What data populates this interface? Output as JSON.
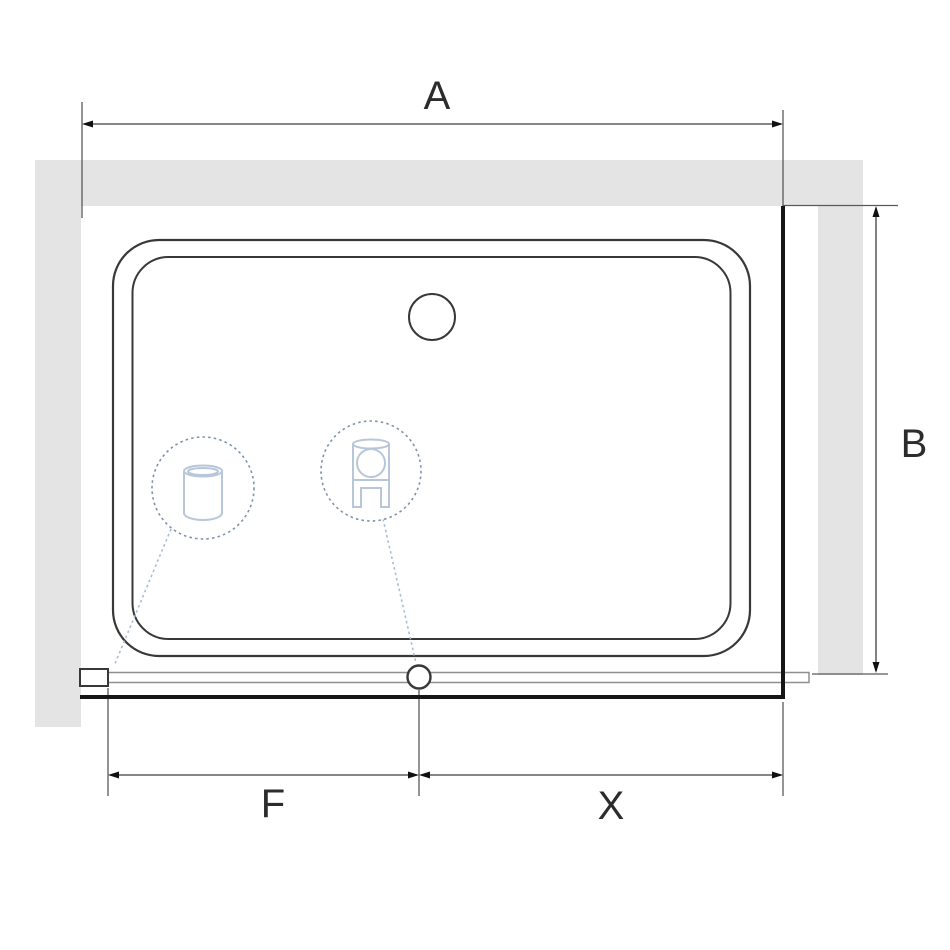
{
  "diagram": {
    "dimension_labels": {
      "overall_width": "A",
      "overall_depth": "B",
      "fixed_segment": "F",
      "door_segment": "X"
    },
    "callout_icons": [
      {
        "name": "wall-profile-cylinder-icon"
      },
      {
        "name": "roller-carriage-icon"
      }
    ],
    "colors": {
      "background": "#ffffff",
      "wall_fill": "#e4e4e4",
      "drawing_line": "#383838",
      "thick_line": "#161616",
      "dim_line": "#3f3f3f",
      "ext_line": "#5a5a5a",
      "arrow_fill": "#111111",
      "rail_line": "#8f8f8f",
      "callout_circle": "#7e93aa",
      "icon_stroke": "#b7c7d9",
      "leader_line": "#a6bed6",
      "label_text": "#2c2c2c"
    }
  }
}
